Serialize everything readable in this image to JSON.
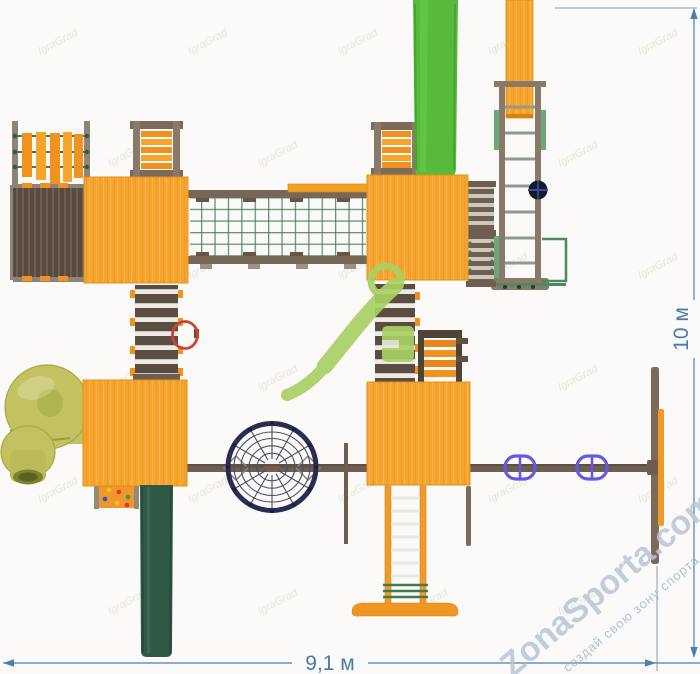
{
  "dimensions": {
    "width_label": "9,1 м",
    "height_label": "10 м",
    "line_color": "#4A7FAE",
    "text_color": "#4A7AA8"
  },
  "watermarks": {
    "brand": "ZonaSporta.com",
    "slogan": "создай свою зону спорта",
    "brand_color": "#B7C6D9",
    "slogan_color": "#A3B6CE",
    "logo_color": "#A9D063",
    "tile_text": "IgraGrad",
    "tile_color": "#E2E7D2"
  },
  "palette": {
    "background": "#FBFAF9",
    "tower_orange": "#F6A42B",
    "rung_orange": "#F0921F",
    "wood_brown": "#7C6B5B",
    "deck_brown": "#6F5D4F",
    "rope_green": "#3E7C52",
    "slide_bright_green": "#57BA3D",
    "slide_dark_green": "#2F5845",
    "tube_olive": "#C2C360",
    "web_navy": "#272E52",
    "swing_purple": "#6459E0",
    "basketball_red": "#CE4337"
  },
  "parts": [
    "tower-roof-top-left",
    "tower-roof-top-right",
    "tower-roof-bottom-left",
    "tower-roof-bottom-right",
    "hanging-plank-bridge",
    "wooden-deck",
    "climbing-ramp",
    "net-crossing-bridge",
    "balance-beam",
    "plank-walkway",
    "overhead-ladder",
    "steering-wheel",
    "gym-frame",
    "tall-orange-beam",
    "green-slide",
    "stair-steps",
    "orange-step-ramp",
    "basketball-ring",
    "tube-slide",
    "climbing-wall",
    "dark-green-slide",
    "spider-web-net",
    "crossbeam",
    "swing-seat",
    "swing-frame-post",
    "gym-ladder",
    "support-post"
  ]
}
